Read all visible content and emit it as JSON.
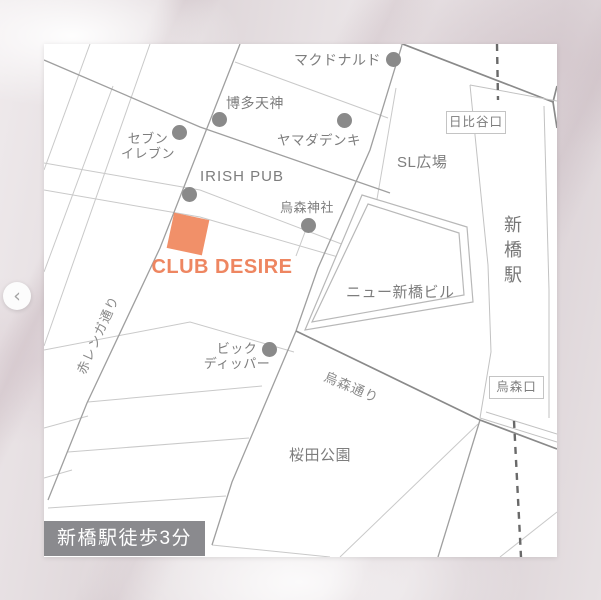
{
  "venue": {
    "name": "CLUB DESIRE"
  },
  "landmarks": {
    "mcdonalds": {
      "label": "マクドナルド"
    },
    "hakata_tenjin": {
      "label": "博多天神"
    },
    "seven_eleven": {
      "line1": "セブン",
      "line2": "イレブン"
    },
    "yamada_denki": {
      "label": "ヤマダデンキ"
    },
    "irish_pub": {
      "label": "IRISH PUB"
    },
    "karasumori_shrine": {
      "label": "烏森神社"
    },
    "big_dipper": {
      "line1": "ビック",
      "line2": "ディッパー"
    }
  },
  "streets": {
    "akarenga_dori": "赤レンガ通り",
    "karasumori_dori": "烏森通り"
  },
  "areas": {
    "sl_plaza": "SL広場",
    "new_shinbashi_building": "ニュー新橋ビル",
    "sakurada_park": "桜田公園"
  },
  "station": {
    "name": "新橋駅",
    "exits": {
      "hibiya": "日比谷口",
      "karasumori": "烏森口"
    }
  },
  "badge": {
    "label": "新橋駅徒歩3分"
  },
  "carousel": {
    "prev_icon": "‹"
  },
  "colors": {
    "accent_orange": "#EE8661",
    "marker_square_orange": "#F19069",
    "marker_dot_gray": "#8A8A8A",
    "badge_bg": "#8A8A8E",
    "road_light": "#C9C9C9",
    "road_dark": "#8A8A8A",
    "label_gray": "#7D7D7D"
  }
}
